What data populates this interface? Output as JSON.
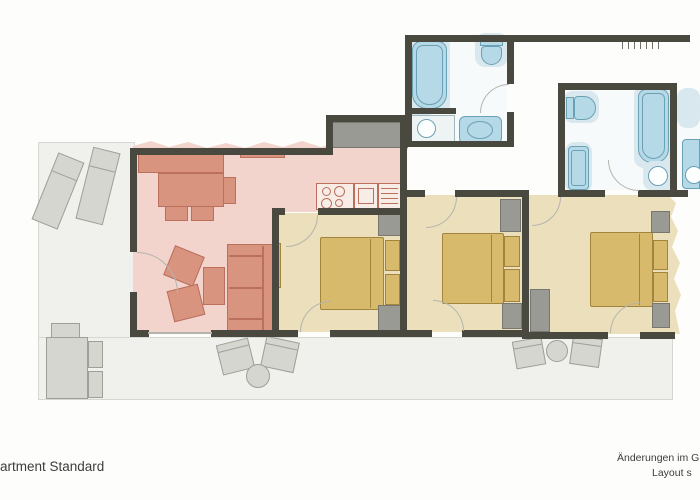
{
  "captions": {
    "bottom_left": "artment Standard",
    "bottom_right_line1": "Änderungen im Grun",
    "bottom_right_line2": "Layout s"
  },
  "palette": {
    "wall": "#49493f",
    "living-floor": "#f2d4cd",
    "living-furniture": "#d8947f",
    "living-furniture-border": "#bb6f5d",
    "bedroom-floor": "#ebdfbc",
    "bed": "#d8ba6c",
    "bed-border": "#a2843c",
    "wardrobe": "#9a9a95",
    "fixture": "#b5d9e6",
    "fixture-border": "#6ba1b5",
    "splash": "#d8e8ee",
    "terrace": "#f0f0ed",
    "outdoor": "#d6d6d1",
    "arc": "#b4b4ae",
    "text": "#3d3d3d"
  }
}
